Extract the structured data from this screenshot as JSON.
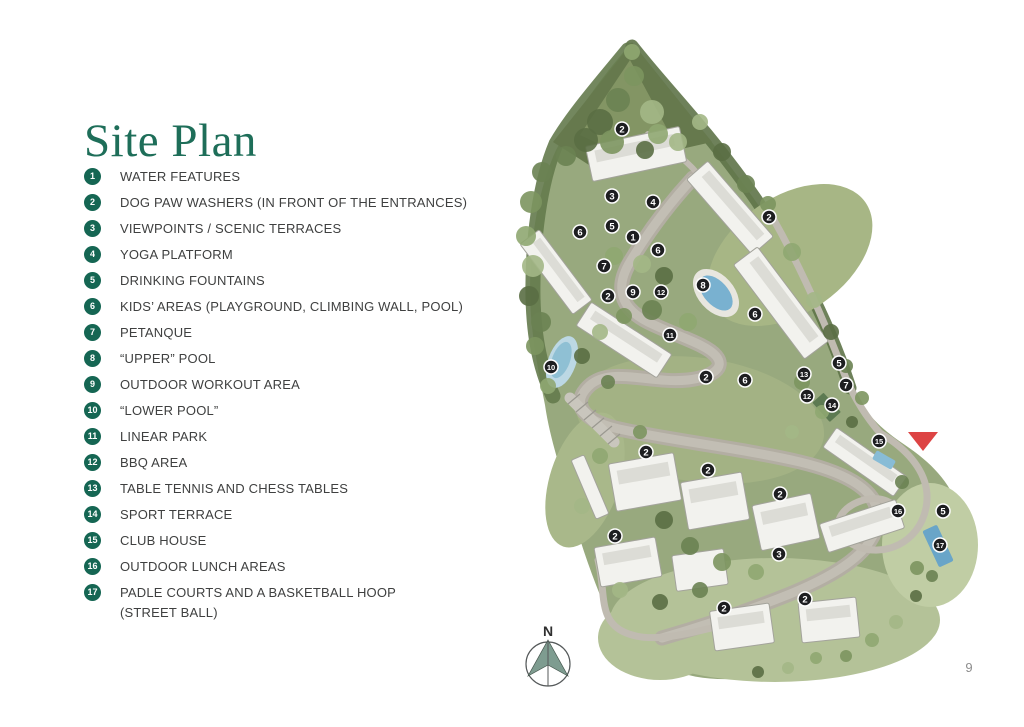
{
  "page": {
    "title": "Site Plan",
    "page_number": "9"
  },
  "colors": {
    "title": "#1e6e59",
    "legend_badge": "#156653",
    "legend_text": "#3f4040",
    "map_marker": "#1d1e20",
    "entrance_red": "#dd4444",
    "compass_fill": "#7e9c90"
  },
  "legend": {
    "items": [
      {
        "number": "1",
        "label": "WATER FEATURES"
      },
      {
        "number": "2",
        "label": "DOG PAW WASHERS (IN FRONT OF THE ENTRANCES)"
      },
      {
        "number": "3",
        "label": "VIEWPOINTS / SCENIC TERRACES"
      },
      {
        "number": "4",
        "label": "YOGA PLATFORM"
      },
      {
        "number": "5",
        "label": "DRINKING FOUNTAINS"
      },
      {
        "number": "6",
        "label": "KIDS’ AREAS (PLAYGROUND, CLIMBING WALL, POOL)"
      },
      {
        "number": "7",
        "label": "PETANQUE"
      },
      {
        "number": "8",
        "label": "“UPPER” POOL"
      },
      {
        "number": "9",
        "label": "OUTDOOR WORKOUT AREA"
      },
      {
        "number": "10",
        "label": "“LOWER POOL”"
      },
      {
        "number": "11",
        "label": "LINEAR PARK"
      },
      {
        "number": "12",
        "label": "BBQ AREA"
      },
      {
        "number": "13",
        "label": "TABLE TENNIS AND CHESS TABLES"
      },
      {
        "number": "14",
        "label": "SPORT TERRACE"
      },
      {
        "number": "15",
        "label": "CLUB HOUSE"
      },
      {
        "number": "16",
        "label": "OUTDOOR LUNCH AREAS"
      },
      {
        "number": "17",
        "label": "PADLE COURTS AND A BASKETBALL HOOP\n(STREET BALL)"
      }
    ]
  },
  "map": {
    "compass_label": "N",
    "marker_color": "#1d1e20",
    "entrance_color": "#dd4444",
    "entrance": {
      "x": 923,
      "y": 441
    },
    "markers": [
      {
        "n": "2",
        "x": 622,
        "y": 129
      },
      {
        "n": "3",
        "x": 612,
        "y": 196
      },
      {
        "n": "4",
        "x": 653,
        "y": 202
      },
      {
        "n": "2",
        "x": 769,
        "y": 217
      },
      {
        "n": "5",
        "x": 612,
        "y": 226
      },
      {
        "n": "6",
        "x": 580,
        "y": 232
      },
      {
        "n": "1",
        "x": 633,
        "y": 237
      },
      {
        "n": "6",
        "x": 658,
        "y": 250
      },
      {
        "n": "7",
        "x": 604,
        "y": 266
      },
      {
        "n": "8",
        "x": 703,
        "y": 285
      },
      {
        "n": "9",
        "x": 633,
        "y": 292
      },
      {
        "n": "12",
        "x": 661,
        "y": 292
      },
      {
        "n": "2",
        "x": 608,
        "y": 296
      },
      {
        "n": "6",
        "x": 755,
        "y": 314
      },
      {
        "n": "11",
        "x": 670,
        "y": 335
      },
      {
        "n": "5",
        "x": 839,
        "y": 363
      },
      {
        "n": "10",
        "x": 551,
        "y": 367
      },
      {
        "n": "13",
        "x": 804,
        "y": 374
      },
      {
        "n": "2",
        "x": 706,
        "y": 377
      },
      {
        "n": "6",
        "x": 745,
        "y": 380
      },
      {
        "n": "7",
        "x": 846,
        "y": 385
      },
      {
        "n": "12",
        "x": 807,
        "y": 396
      },
      {
        "n": "14",
        "x": 832,
        "y": 405
      },
      {
        "n": "15",
        "x": 879,
        "y": 441
      },
      {
        "n": "2",
        "x": 646,
        "y": 452
      },
      {
        "n": "2",
        "x": 708,
        "y": 470
      },
      {
        "n": "2",
        "x": 780,
        "y": 494
      },
      {
        "n": "16",
        "x": 898,
        "y": 511
      },
      {
        "n": "5",
        "x": 943,
        "y": 511
      },
      {
        "n": "2",
        "x": 615,
        "y": 536
      },
      {
        "n": "17",
        "x": 940,
        "y": 545
      },
      {
        "n": "3",
        "x": 779,
        "y": 554
      },
      {
        "n": "2",
        "x": 805,
        "y": 599
      },
      {
        "n": "2",
        "x": 724,
        "y": 608
      }
    ]
  }
}
